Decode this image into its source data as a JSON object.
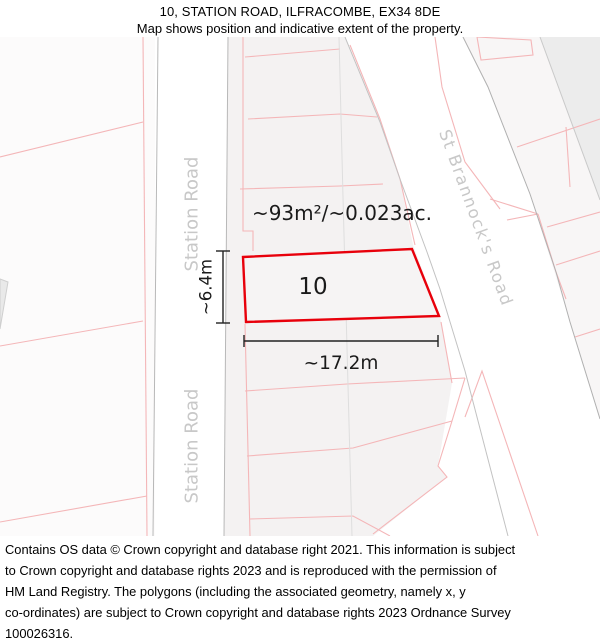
{
  "header": {
    "line1": "10, STATION ROAD, ILFRACOMBE, EX34 8DE",
    "line2": "Map shows position and indicative extent of the property."
  },
  "map": {
    "property_number": "10",
    "area_label": "~93m²/~0.023ac.",
    "width_label": "~17.2m",
    "height_label": "~6.4m",
    "road_labels": {
      "station_road_upper": "Station Road",
      "station_road_lower": "Station Road",
      "st_brannocks": "St Brannock's Road"
    },
    "colors": {
      "property_outline": "#e8000b",
      "parcel_line": "#f4b6b8",
      "road_edge_line": "#b8b8b8",
      "faint_line": "#dedede",
      "road_label_text": "#c8c8c8",
      "parcel_fill": "#f4f2f2",
      "dimension_line": "#222222"
    }
  },
  "footer": {
    "lines": [
      "Contains OS data © Crown copyright and database right 2021. This information is subject",
      "to Crown copyright and database rights 2023 and is reproduced with the permission of",
      "HM Land Registry. The polygons (including the associated geometry, namely x, y",
      "co-ordinates) are subject to Crown copyright and database rights 2023 Ordnance Survey",
      "100026316."
    ]
  }
}
